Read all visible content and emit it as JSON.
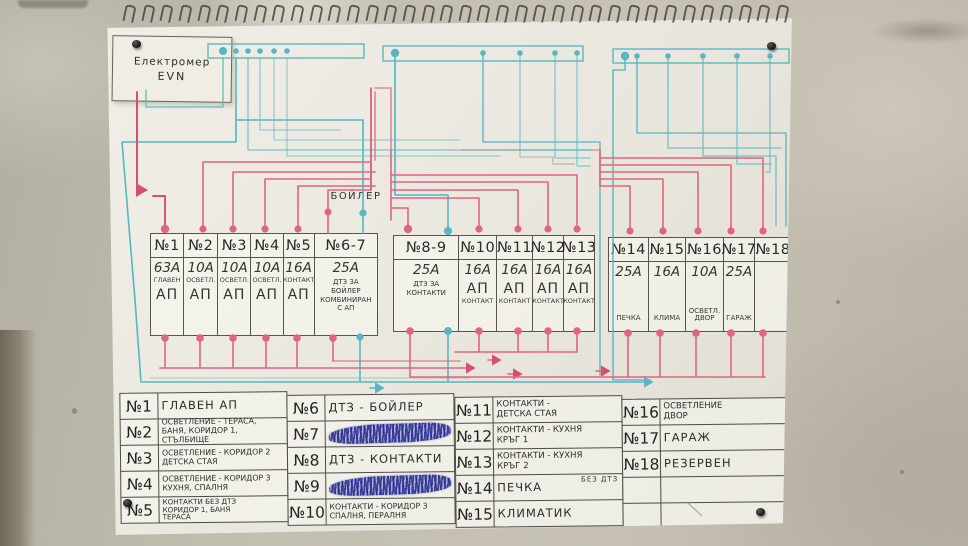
{
  "meter": {
    "line1": "Електромер",
    "line2": "EVN"
  },
  "boiler_label": "БОЙЛЕР",
  "panels": [
    {
      "columns": [
        {
          "no": "№1",
          "amp": "63А",
          "tag": "ГЛАВЕН",
          "ap": "АП"
        },
        {
          "no": "№2",
          "amp": "10А",
          "tag": "ОСВЕТЛ.",
          "ap": "АП"
        },
        {
          "no": "№3",
          "amp": "10А",
          "tag": "ОСВЕТЛ.",
          "ap": "АП"
        },
        {
          "no": "№4",
          "amp": "10А",
          "tag": "ОСВЕТЛ.",
          "ap": "АП"
        },
        {
          "no": "№5",
          "amp": "16А",
          "tag": "КОНТАКТ",
          "ap": "АП"
        },
        {
          "no": "№6-7",
          "amp": "25А",
          "desc": "ДТЗ ЗА\nБОЙЛЕР\nКОМБИНИРАН\nС АП"
        }
      ]
    },
    {
      "columns": [
        {
          "no": "№8-9",
          "amp": "25А",
          "desc": "ДТЗ ЗА\nКОНТАКТИ"
        },
        {
          "no": "№10",
          "amp": "16А",
          "ap": "АП",
          "tag": "КОНТАКТ"
        },
        {
          "no": "№11",
          "amp": "16А",
          "ap": "АП",
          "tag": "КОНТАКТ"
        },
        {
          "no": "№12",
          "amp": "16А",
          "ap": "АП",
          "tag": "КОНТАКТ"
        },
        {
          "no": "№13",
          "amp": "16А",
          "ap": "АП",
          "tag": "КОНТАКТ"
        }
      ]
    },
    {
      "columns": [
        {
          "no": "№14",
          "amp": "25А",
          "tag": "ПЕЧКА"
        },
        {
          "no": "№15",
          "amp": "16А",
          "tag": "КЛИМА"
        },
        {
          "no": "№16",
          "amp": "10А",
          "tag": "ОСВЕТЛ.\nДВОР"
        },
        {
          "no": "№17",
          "amp": "25А",
          "tag": "ГАРАЖ"
        },
        {
          "no": "№18",
          "amp": "",
          "tag": ""
        }
      ]
    }
  ],
  "legend": {
    "groups": [
      {
        "rows": [
          {
            "no": "№1",
            "desc": "ГЛАВЕН  АП"
          },
          {
            "no": "№2",
            "desc": "ОСВЕТЛЕНИЕ - ТЕРАСА,\nБАНЯ, КОРИДОР 1, СТЪЛБИЩЕ"
          },
          {
            "no": "№3",
            "desc": "ОСВЕТЛЕНИЕ - КОРИДОР 2\nДЕТСКА СТАЯ"
          },
          {
            "no": "№4",
            "desc": "ОСВЕТЛЕНИЕ - КОРИДОР 3\nКУХНЯ, СПАЛНЯ"
          },
          {
            "no": "№5",
            "desc": "КОНТАКТИ БЕЗ ДТЗ\nКОРИДОР 1, БАНЯ\nТЕРАСА"
          }
        ]
      },
      {
        "rows": [
          {
            "no": "№6",
            "desc": "ДТЗ - БОЙЛЕР"
          },
          {
            "no": "№7",
            "desc": "",
            "scribbled": true
          },
          {
            "no": "№8",
            "desc": "ДТЗ - КОНТАКТИ"
          },
          {
            "no": "№9",
            "desc": "",
            "scribbled": true
          },
          {
            "no": "№10",
            "desc": "КОНТАКТИ - КОРИДОР 3\nСПАЛНЯ, ПЕРАЛНЯ"
          }
        ]
      },
      {
        "rows": [
          {
            "no": "№11",
            "desc": "КОНТАКТИ -\nДЕТСКА СТАЯ"
          },
          {
            "no": "№12",
            "desc": "КОНТАКТИ - КУХНЯ\nКРЪГ 1"
          },
          {
            "no": "№13",
            "desc": "КОНТАКТИ - КУХНЯ\nКРЪГ 2"
          },
          {
            "no": "№14",
            "desc": "ПЕЧКА",
            "note": "БЕЗ ДТЗ"
          },
          {
            "no": "№15",
            "desc": "КЛИМАТИК"
          }
        ]
      },
      {
        "rows": [
          {
            "no": "№16",
            "desc": "ОСВЕТЛЕНИЕ\nДВОР"
          },
          {
            "no": "№17",
            "desc": "ГАРАЖ"
          },
          {
            "no": "№18",
            "desc": "РЕЗЕРВЕН"
          },
          {
            "no": "",
            "desc": ""
          },
          {
            "no": "",
            "desc": ""
          }
        ]
      }
    ]
  },
  "colors": {
    "wire_phase_pink": "#e0667f",
    "wire_phase_red": "#d6506a",
    "wire_neutral_teal": "#57b6c2",
    "pencil": "#57554f",
    "ink_scribble_blue": "#282c94",
    "paper": "#eceae2",
    "wall": "#bdb9ac"
  },
  "spiral_loop_count": 36
}
